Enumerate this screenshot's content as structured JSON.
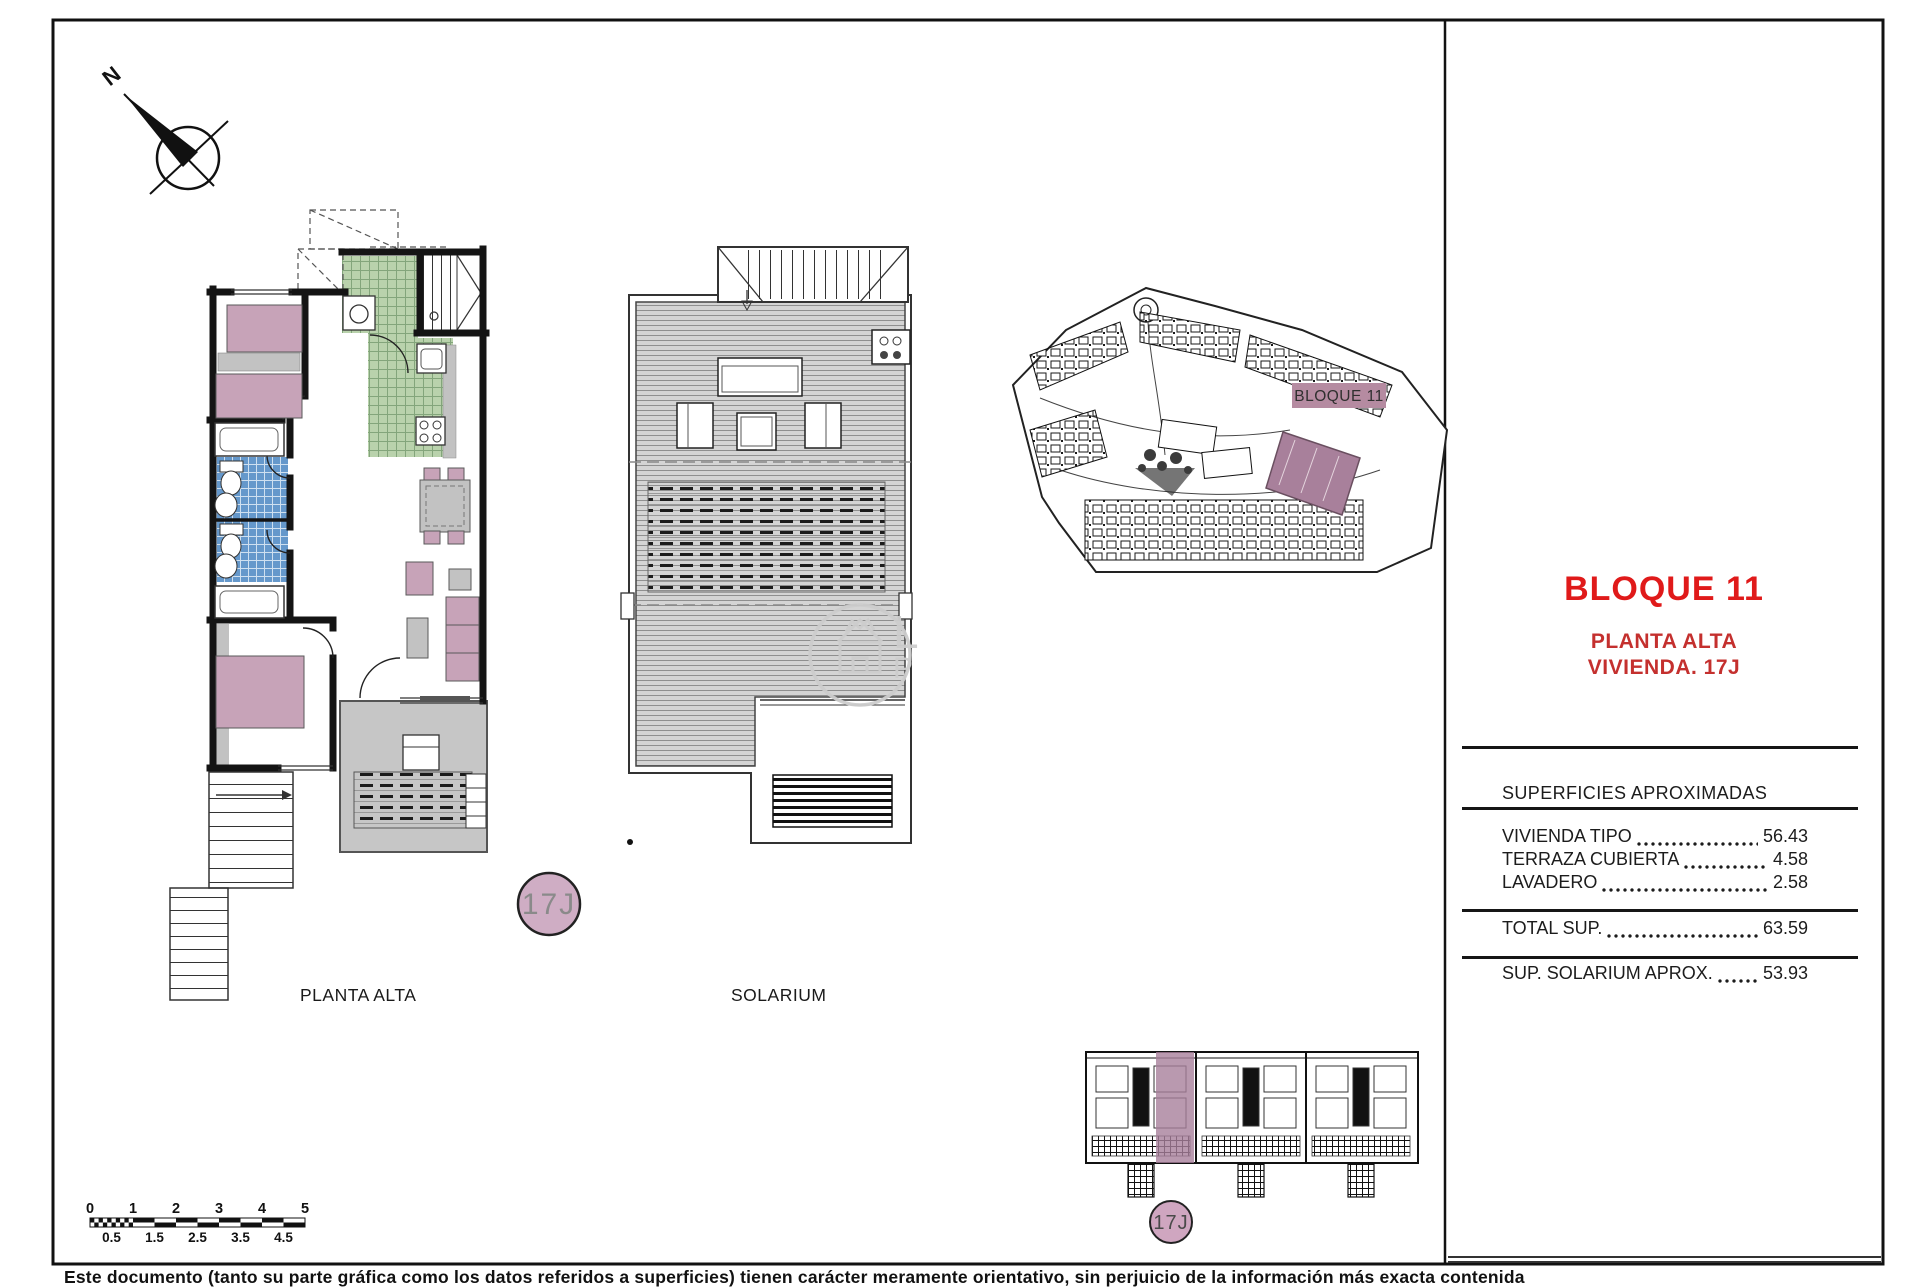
{
  "compass": {
    "label": "N"
  },
  "floor_plan": {
    "label": "PLANTA ALTA",
    "unit_badge": "17J"
  },
  "solarium": {
    "label": "SOLARIUM"
  },
  "site_plan": {
    "block_label": "BLOQUE 11"
  },
  "key_plan": {
    "unit_badge": "17J"
  },
  "watermark": {
    "letter_top": "L",
    "letter_bottom": "P"
  },
  "title_block": {
    "title": "BLOQUE 11",
    "subtitle_line1": "PLANTA ALTA",
    "subtitle_line2": "VIVIENDA. 17J",
    "surfaces": {
      "header": "SUPERFICIES APROXIMADAS",
      "rows": [
        {
          "label": "VIVIENDA TIPO",
          "value": "56.43"
        },
        {
          "label": "TERRAZA CUBIERTA",
          "value": "4.58"
        },
        {
          "label": "LAVADERO",
          "value": "2.58"
        }
      ],
      "total": {
        "label": "TOTAL SUP.",
        "value": "63.59"
      },
      "solarium_row": {
        "label": "SUP. SOLARIUM APROX.",
        "value": "53.93"
      }
    }
  },
  "scale_bar": {
    "top_labels": [
      "0",
      "1",
      "2",
      "3",
      "4",
      "5"
    ],
    "bottom_labels": [
      "0.5",
      "1.5",
      "2.5",
      "3.5",
      "4.5"
    ]
  },
  "footer": {
    "disclaimer": "Este documento (tanto su parte gráfica como los datos referidos a superficies) tienen carácter meramente orientativo, sin perjuicio de la información más exacta contenida"
  },
  "colors": {
    "accent_red": "#e01a1a",
    "subtitle_red": "#c4302e",
    "highlight_mauve": "#a8809b",
    "label_mauve": "#b58ba1",
    "furniture_pink": "#c7a3b8",
    "badge_pink": "#cfadc4",
    "tile_green": "#b9d2ac",
    "tile_blue": "#6598cb",
    "floor_gray": "#c6c6c6"
  }
}
